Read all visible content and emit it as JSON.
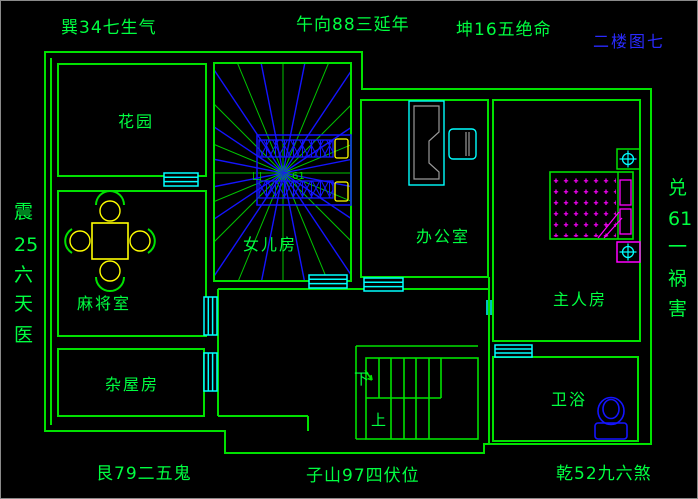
{
  "colors": {
    "background": "#000000",
    "wall_green": "#00e100",
    "text_green": "#00ff41",
    "window_cyan": "#00ffff",
    "blue": "#1414ff",
    "annotation_blue": "#2a2aff",
    "yellow": "#ffff00",
    "magenta": "#ff00ff",
    "desk_gray": "#9a9a9a"
  },
  "annotations": {
    "top_left": "巽34七生气",
    "top_center": "午向88三延年",
    "top_right": "坤16五绝命",
    "corner_blue": "二楼图七",
    "bottom_left": "艮79二五鬼",
    "bottom_center": "子山97四伏位",
    "bottom_right": "乾52九六煞",
    "left_vertical": [
      "震",
      "25",
      "六",
      "天",
      "医"
    ],
    "right_vertical": [
      "兑",
      "61",
      "一",
      "祸",
      "害"
    ]
  },
  "rooms": {
    "garden": "花园",
    "mahjong": "麻将室",
    "storage": "杂屋房",
    "daughter": "女儿房",
    "office": "办公室",
    "master": "主人房",
    "bathroom": "卫浴"
  },
  "stairs": {
    "down": "下",
    "up": "上"
  },
  "center_marks": {
    "left": "凵",
    "right": "61"
  }
}
